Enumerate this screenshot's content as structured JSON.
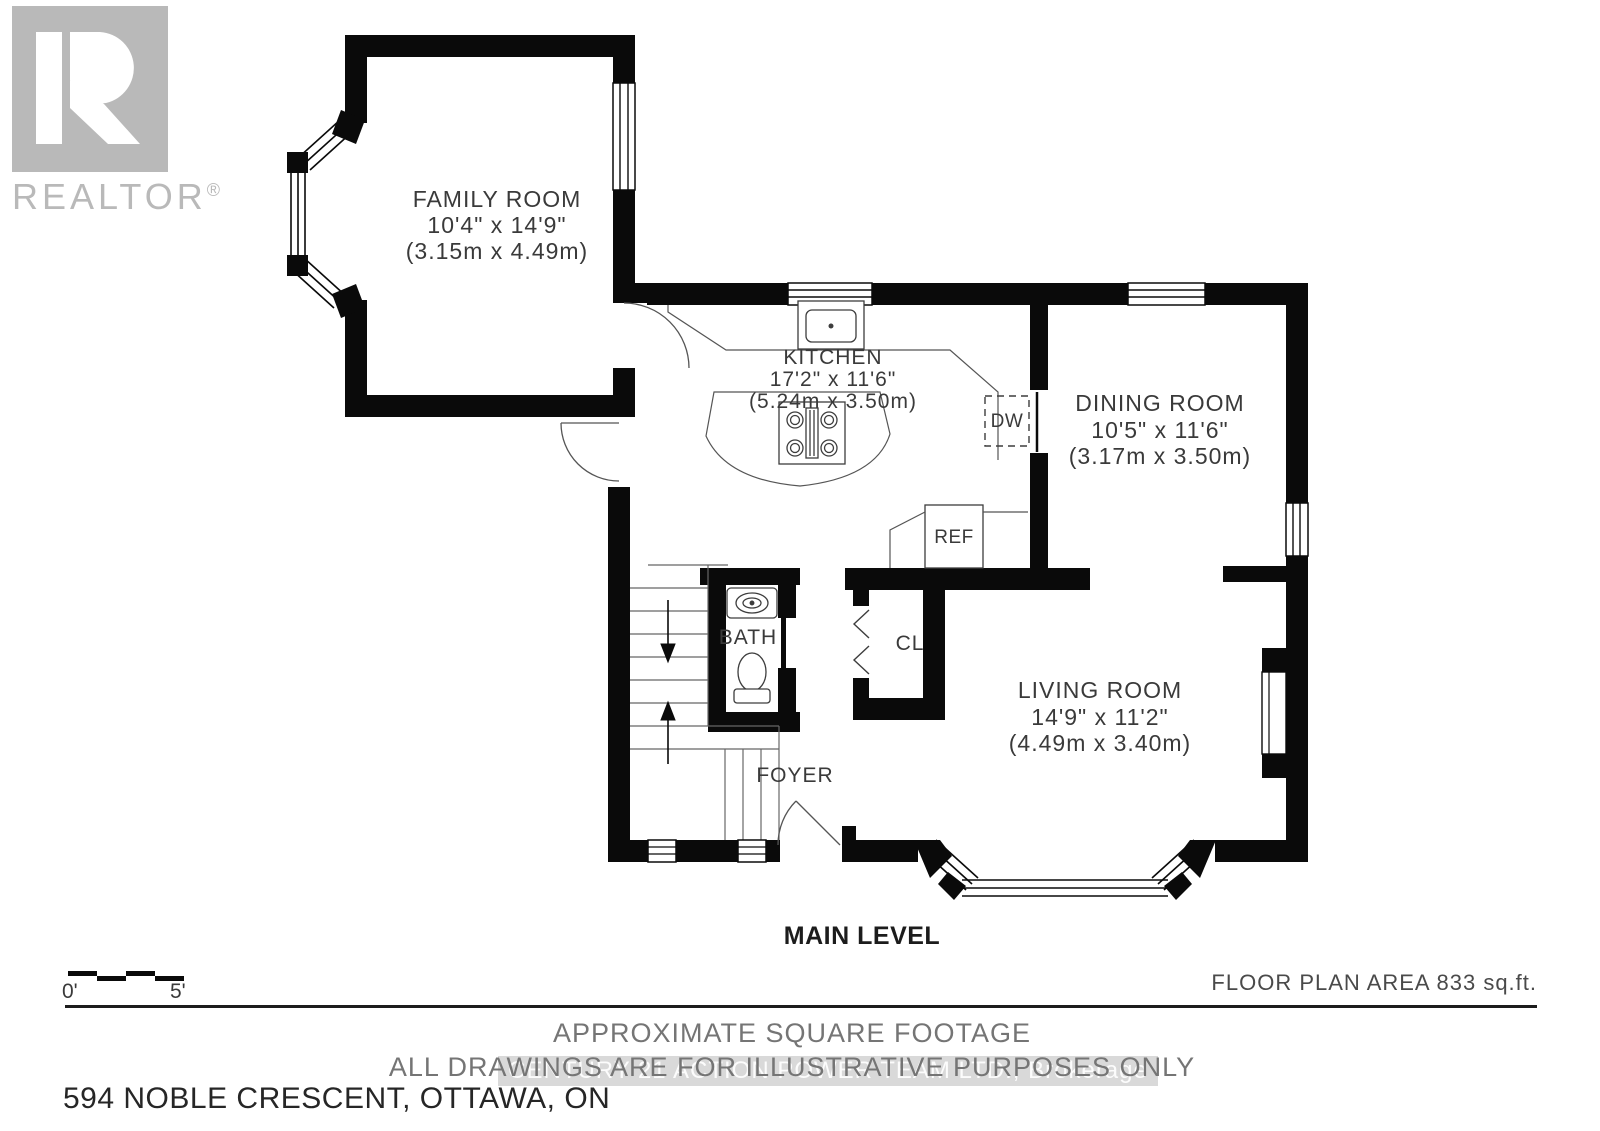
{
  "logo": {
    "r_glyph": "R",
    "realtor_text": "REALTOR",
    "registered_mark": "®"
  },
  "plan": {
    "rooms": [
      {
        "name": "FAMILY ROOM",
        "dims_ft": "10'4\" x 14'9\"",
        "dims_m": "(3.15m x 4.49m)"
      },
      {
        "name": "KITCHEN",
        "dims_ft": "17'2\" x 11'6\"",
        "dims_m": "(5.24m x 3.50m)"
      },
      {
        "name": "DINING ROOM",
        "dims_ft": "10'5\" x 11'6\"",
        "dims_m": "(3.17m x 3.50m)"
      },
      {
        "name": "LIVING ROOM",
        "dims_ft": "14'9\" x 11'2\"",
        "dims_m": "(4.49m x 3.40m)"
      }
    ],
    "labels": {
      "bath": "BATH",
      "closet": "CL",
      "foyer": "FOYER",
      "fridge": "REF",
      "dishwasher": "DW"
    },
    "level_title": "MAIN LEVEL"
  },
  "scale_bar": {
    "start": "0'",
    "end": "5'"
  },
  "footer": {
    "area": "FLOOR PLAN AREA 833 sq.ft.",
    "disclaimer_line1": "APPROXIMATE SQUARE FOOTAGE",
    "disclaimer_line2": "ALL DRAWINGS ARE FOR ILLUSTRATIVE PURPOSES ONLY",
    "watermark": "CENTURY 21 ACTION POWER TEAM LTD., Brokerage",
    "address": "594 NOBLE CRESCENT, OTTAWA, ON"
  },
  "colors": {
    "wall": "#0a0a0a",
    "text": "#3a3a3a",
    "logo_gray": "#b9b9b9"
  }
}
